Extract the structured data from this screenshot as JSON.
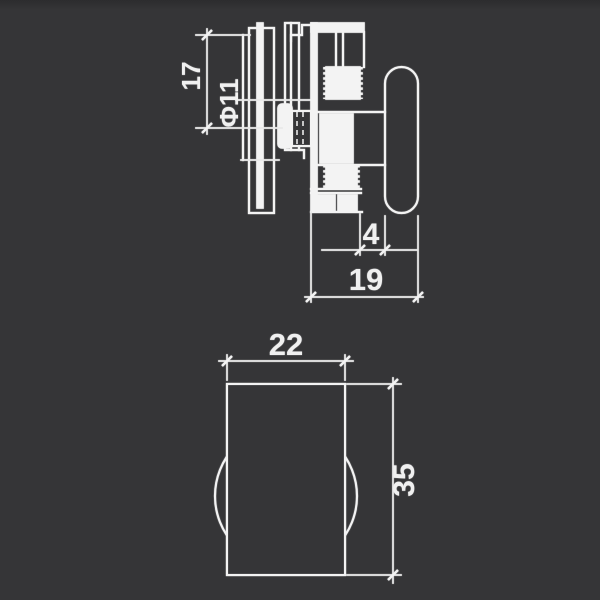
{
  "canvas": {
    "background_color": "#353537",
    "line_color": "#f3f3f3",
    "text_color": "#f0f0f0",
    "width": 600,
    "height": 600
  },
  "drawing": {
    "kind": "engineering-dimension-drawing",
    "subject": "shower-door-roller-bracket",
    "views": [
      {
        "name": "side-view-assembly",
        "dimensions": [
          "17",
          "Φ11",
          "4",
          "19"
        ]
      },
      {
        "name": "front-view-roller",
        "dimensions": [
          "22",
          "35"
        ]
      }
    ]
  },
  "labels": {
    "dim_17": "17",
    "dim_dia_11": "Φ11",
    "dim_4": "4",
    "dim_19": "19",
    "dim_22": "22",
    "dim_35": "35"
  }
}
